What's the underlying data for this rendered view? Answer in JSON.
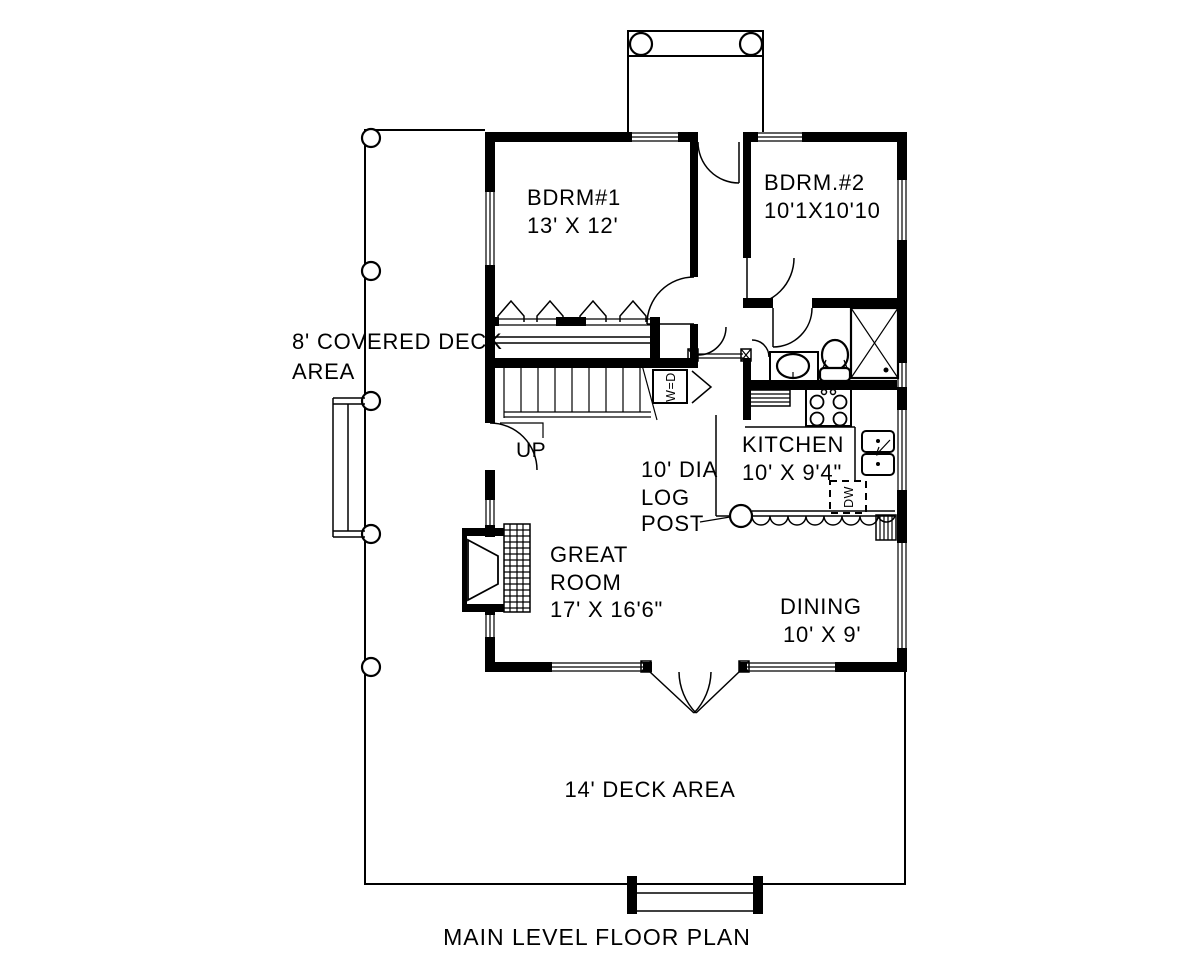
{
  "drawing_title": "MAIN LEVEL FLOOR PLAN",
  "colors": {
    "line": "#000000",
    "background": "#ffffff"
  },
  "rooms": {
    "bdrm1": {
      "name": "BDRM#1",
      "dims": "13' X 12'"
    },
    "bdrm2": {
      "name": "BDRM.#2",
      "dims": "10'1X10'10"
    },
    "kitchen": {
      "name": "KITCHEN",
      "dims": "10' X 9'4\""
    },
    "great_room": {
      "line1": "GREAT",
      "line2": "ROOM",
      "dims": "17' X 16'6\""
    },
    "dining": {
      "name": "DINING",
      "dims": "10' X 9'"
    }
  },
  "areas": {
    "covered_deck_line1": "8' COVERED DECK",
    "covered_deck_line2": "AREA",
    "deck": "14' DECK AREA"
  },
  "annotations": {
    "log_post_line1": "10' DIA",
    "log_post_line2": "LOG",
    "log_post_line3": "POST",
    "stairs_up": "UP",
    "washer_dryer": "W=D",
    "dishwasher": "DW"
  }
}
